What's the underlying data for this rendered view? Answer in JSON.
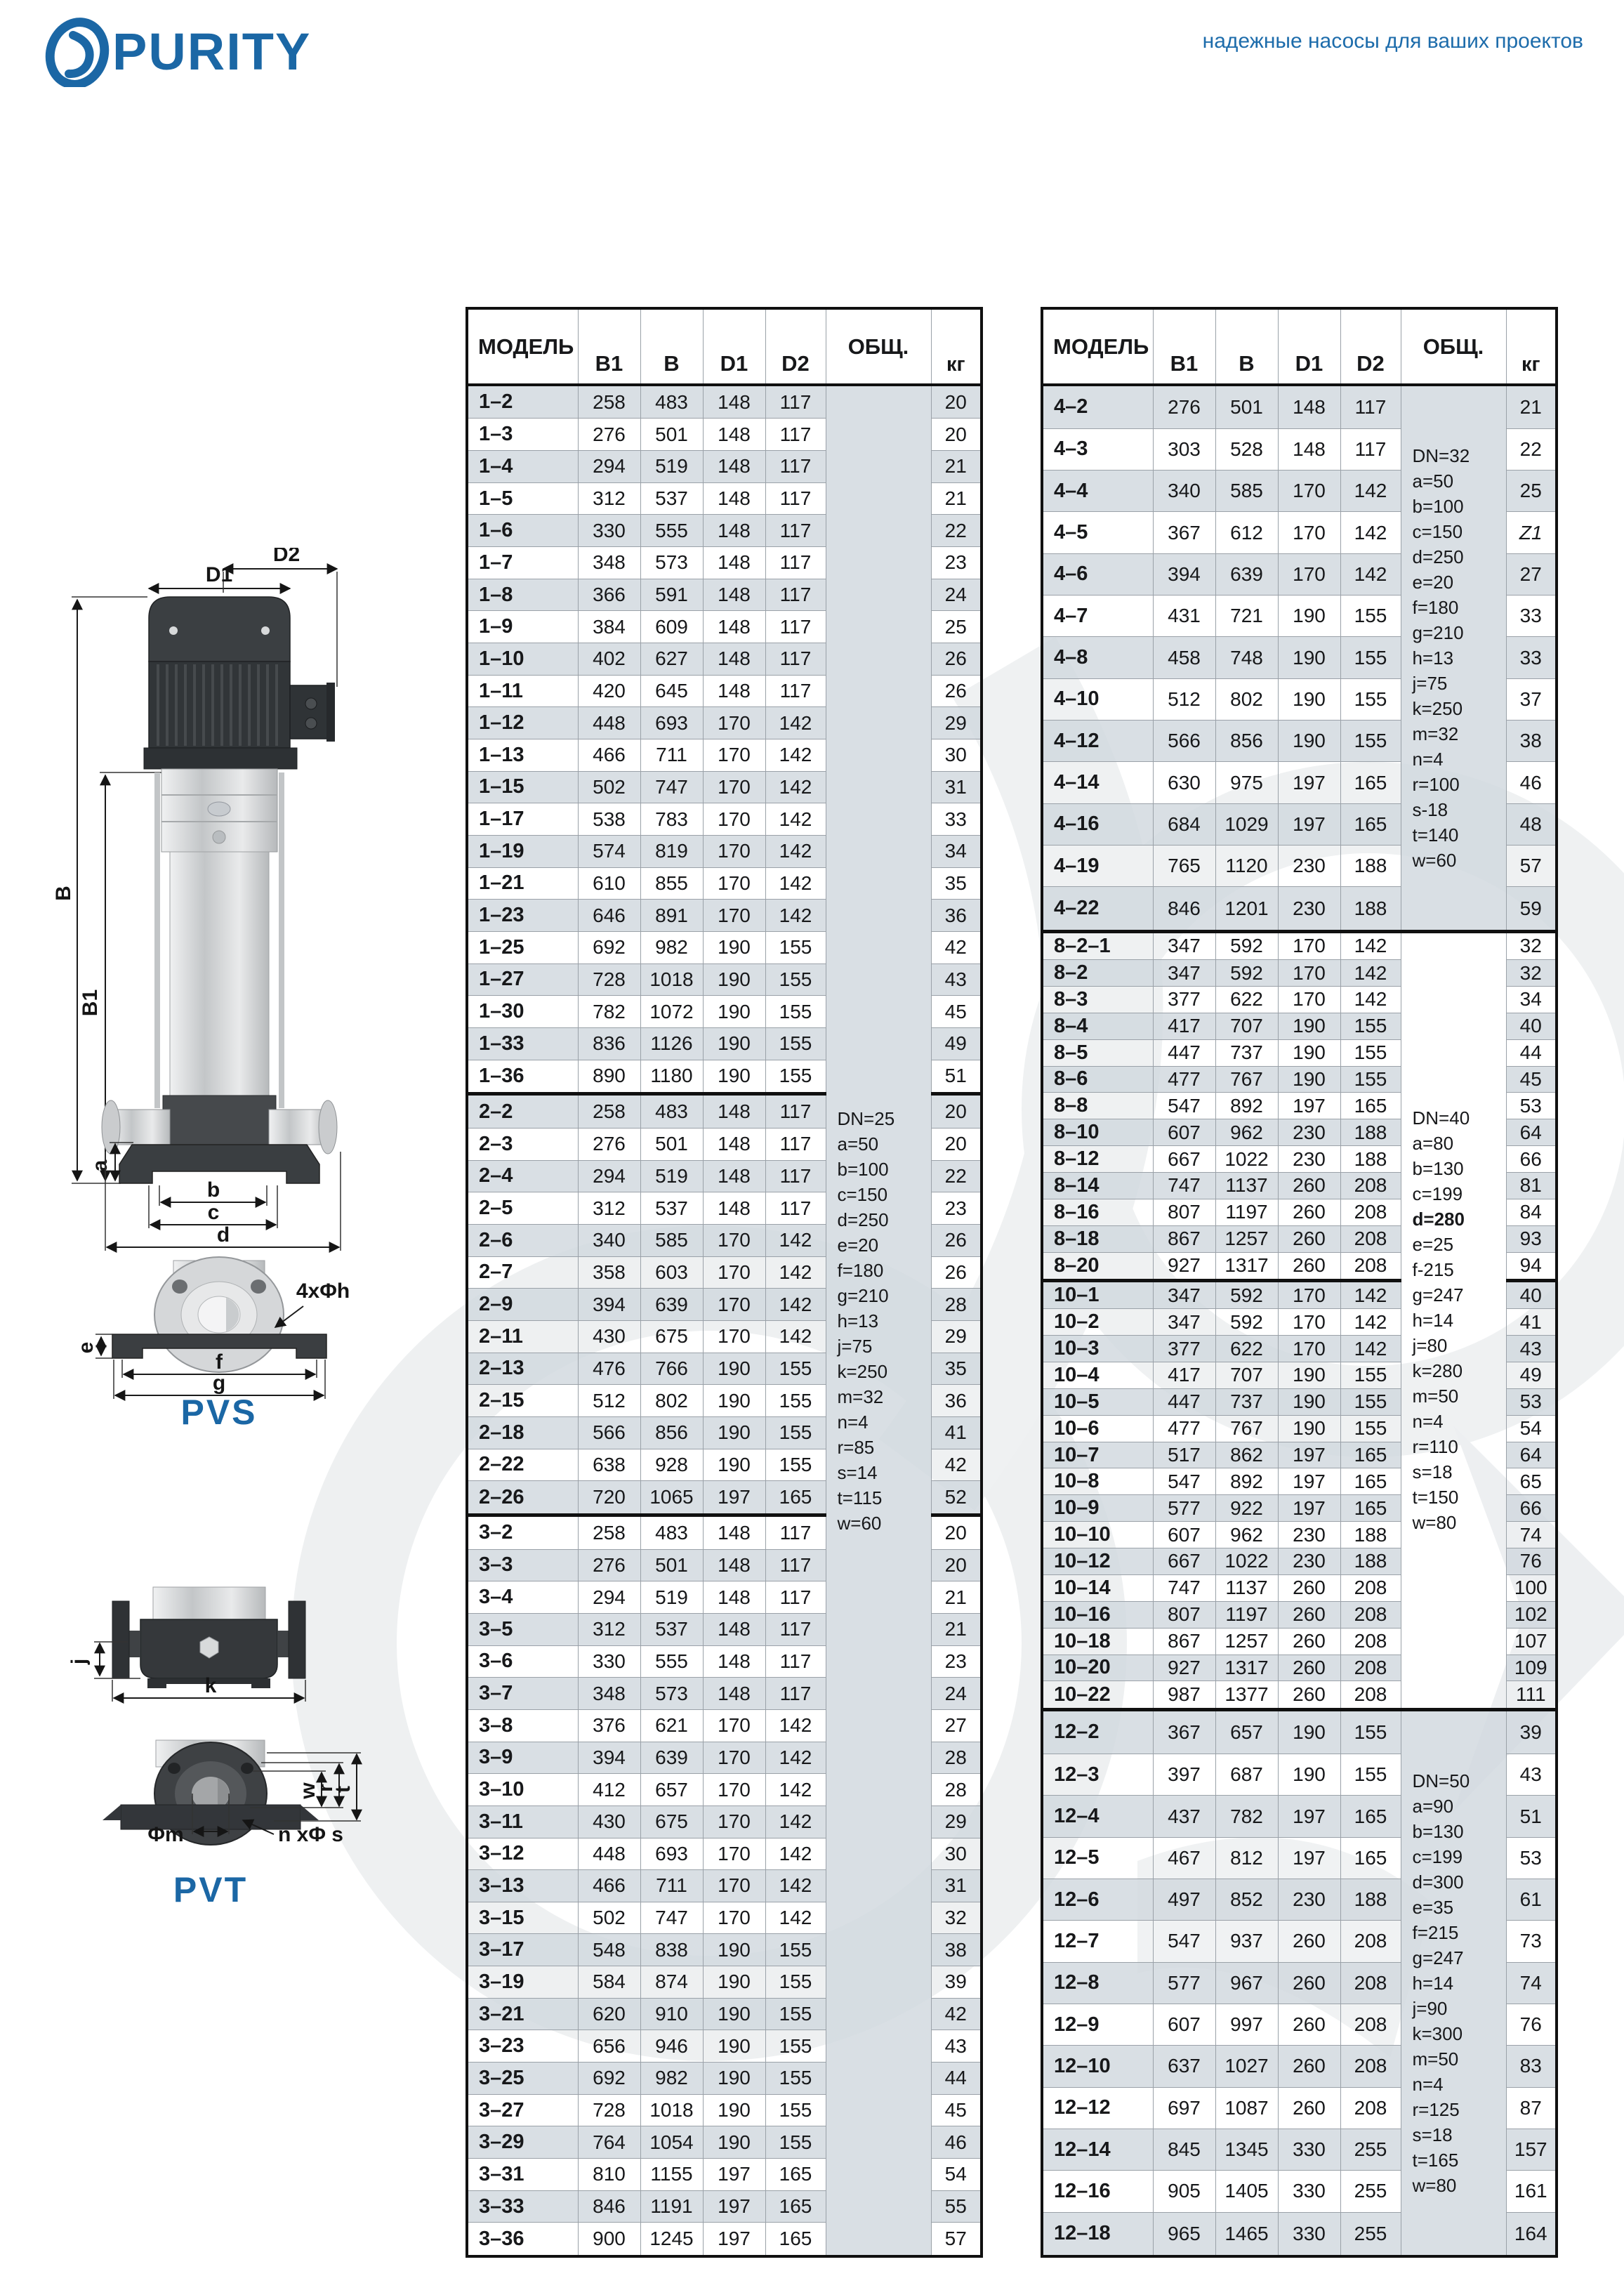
{
  "brand": {
    "logo_text": "PURITY",
    "tagline": "надежные насосы для ваших проектов"
  },
  "diagrams": {
    "pvs": {
      "label": "PVS",
      "d1": "D1",
      "d2": "D2",
      "b_total": "B",
      "b1": "B1",
      "a": "a",
      "dim_b": "b",
      "dim_c": "c",
      "dim_d": "d",
      "bolt_note": "4xΦh",
      "e": "e",
      "f": "f",
      "g": "g"
    },
    "pvt": {
      "label": "PVT",
      "j": "j",
      "k": "k",
      "m": "Φm",
      "bolt_note": "n xΦ s",
      "w": "w",
      "r": "r",
      "t": "t"
    }
  },
  "tables": {
    "headers": {
      "model": "МОДЕЛЬ",
      "b1": "B1",
      "b": "B",
      "d1": "D1",
      "d2": "D2",
      "total": "ОБЩ.",
      "kg": "кг"
    },
    "italic_kg": "Z1",
    "left": {
      "sections": [
        {
          "note_rows": 58,
          "note_lines": [
            "DN=25",
            "a=50",
            "b=100",
            "c=150",
            "d=250",
            "e=20",
            "f=180",
            "g=210",
            "h=13",
            "j=75",
            "k=250",
            "m=32",
            "n=4",
            "r=85",
            "s=14",
            "t=115",
            "w=60"
          ],
          "rows": [
            [
              "1–2",
              258,
              483,
              148,
              117,
              "20"
            ],
            [
              "1–3",
              276,
              501,
              148,
              117,
              "20"
            ],
            [
              "1–4",
              294,
              519,
              148,
              117,
              "21"
            ],
            [
              "1–5",
              312,
              537,
              148,
              117,
              "21"
            ],
            [
              "1–6",
              330,
              555,
              148,
              117,
              "22"
            ],
            [
              "1–7",
              348,
              573,
              148,
              117,
              "23"
            ],
            [
              "1–8",
              366,
              591,
              148,
              117,
              "24"
            ],
            [
              "1–9",
              384,
              609,
              148,
              117,
              "25"
            ],
            [
              "1–10",
              402,
              627,
              148,
              117,
              "26"
            ],
            [
              "1–11",
              420,
              645,
              148,
              117,
              "26"
            ],
            [
              "1–12",
              448,
              693,
              170,
              142,
              "29"
            ],
            [
              "1–13",
              466,
              711,
              170,
              142,
              "30"
            ],
            [
              "1–15",
              502,
              747,
              170,
              142,
              "31"
            ],
            [
              "1–17",
              538,
              783,
              170,
              142,
              "33"
            ],
            [
              "1–19",
              574,
              819,
              170,
              142,
              "34"
            ],
            [
              "1–21",
              610,
              855,
              170,
              142,
              "35"
            ],
            [
              "1–23",
              646,
              891,
              170,
              142,
              "36"
            ],
            [
              "1–25",
              692,
              982,
              190,
              155,
              "42"
            ],
            [
              "1–27",
              728,
              1018,
              190,
              155,
              "43"
            ],
            [
              "1–30",
              782,
              1072,
              190,
              155,
              "45"
            ],
            [
              "1–33",
              836,
              1126,
              190,
              155,
              "49"
            ],
            [
              "1–36",
              890,
              1180,
              190,
              155,
              "51"
            ]
          ]
        },
        {
          "rows": [
            [
              "2–2",
              258,
              483,
              148,
              117,
              "20"
            ],
            [
              "2–3",
              276,
              501,
              148,
              117,
              "20"
            ],
            [
              "2–4",
              294,
              519,
              148,
              117,
              "22"
            ],
            [
              "2–5",
              312,
              537,
              148,
              117,
              "23"
            ],
            [
              "2–6",
              340,
              585,
              170,
              142,
              "26"
            ],
            [
              "2–7",
              358,
              603,
              170,
              142,
              "26"
            ],
            [
              "2–9",
              394,
              639,
              170,
              142,
              "28"
            ],
            [
              "2–11",
              430,
              675,
              170,
              142,
              "29"
            ],
            [
              "2–13",
              476,
              766,
              190,
              155,
              "35"
            ],
            [
              "2–15",
              512,
              802,
              190,
              155,
              "36"
            ],
            [
              "2–18",
              566,
              856,
              190,
              155,
              "41"
            ],
            [
              "2–22",
              638,
              928,
              190,
              155,
              "42"
            ],
            [
              "2–26",
              720,
              1065,
              197,
              165,
              "52"
            ]
          ]
        },
        {
          "rows": [
            [
              "3–2",
              258,
              483,
              148,
              117,
              "20"
            ],
            [
              "3–3",
              276,
              501,
              148,
              117,
              "20"
            ],
            [
              "3–4",
              294,
              519,
              148,
              117,
              "21"
            ],
            [
              "3–5",
              312,
              537,
              148,
              117,
              "21"
            ],
            [
              "3–6",
              330,
              555,
              148,
              117,
              "23"
            ],
            [
              "3–7",
              348,
              573,
              148,
              117,
              "24"
            ],
            [
              "3–8",
              376,
              621,
              170,
              142,
              "27"
            ],
            [
              "3–9",
              394,
              639,
              170,
              142,
              "28"
            ],
            [
              "3–10",
              412,
              657,
              170,
              142,
              "28"
            ],
            [
              "3–11",
              430,
              675,
              170,
              142,
              "29"
            ],
            [
              "3–12",
              448,
              693,
              170,
              142,
              "30"
            ],
            [
              "3–13",
              466,
              711,
              170,
              142,
              "31"
            ],
            [
              "3–15",
              502,
              747,
              170,
              142,
              "32"
            ],
            [
              "3–17",
              548,
              838,
              190,
              155,
              "38"
            ],
            [
              "3–19",
              584,
              874,
              190,
              155,
              "39"
            ],
            [
              "3–21",
              620,
              910,
              190,
              155,
              "42"
            ],
            [
              "3–23",
              656,
              946,
              190,
              155,
              "43"
            ],
            [
              "3–25",
              692,
              982,
              190,
              155,
              "44"
            ],
            [
              "3–27",
              728,
              1018,
              190,
              155,
              "45"
            ],
            [
              "3–29",
              764,
              1054,
              190,
              155,
              "46"
            ],
            [
              "3–31",
              810,
              1155,
              197,
              165,
              "54"
            ],
            [
              "3–33",
              846,
              1191,
              197,
              165,
              "55"
            ],
            [
              "3–36",
              900,
              1245,
              197,
              165,
              "57"
            ]
          ]
        }
      ]
    },
    "right": {
      "sections": [
        {
          "note_rows": 13,
          "note_lines": [
            "DN=32",
            "a=50",
            "b=100",
            "c=150",
            "d=250",
            "e=20",
            "f=180",
            "g=210",
            "h=13",
            "j=75",
            "k=250",
            "m=32",
            "n=4",
            "r=100",
            "s-18",
            "t=140",
            "w=60"
          ],
          "rows": [
            [
              "4–2",
              276,
              501,
              148,
              117,
              "21"
            ],
            [
              "4–3",
              303,
              528,
              148,
              117,
              "22"
            ],
            [
              "4–4",
              340,
              585,
              170,
              142,
              "25"
            ],
            [
              "4–5",
              367,
              612,
              170,
              142,
              "Z1"
            ],
            [
              "4–6",
              394,
              639,
              170,
              142,
              "27"
            ],
            [
              "4–7",
              431,
              721,
              190,
              155,
              "33"
            ],
            [
              "4–8",
              458,
              748,
              190,
              155,
              "33"
            ],
            [
              "4–10",
              512,
              802,
              190,
              155,
              "37"
            ],
            [
              "4–12",
              566,
              856,
              190,
              155,
              "38"
            ],
            [
              "4–14",
              630,
              975,
              197,
              165,
              "46"
            ],
            [
              "4–16",
              684,
              1029,
              197,
              165,
              "48"
            ],
            [
              "4–19",
              765,
              1120,
              230,
              188,
              "57"
            ],
            [
              "4–22",
              846,
              1201,
              230,
              188,
              "59"
            ]
          ]
        },
        {
          "note_rows": 29,
          "note_bold_line": 4,
          "note_lines": [
            "DN=40",
            "a=80",
            "b=130",
            "c=199",
            "d=280",
            "e=25",
            "f-215",
            "g=247",
            "h=14",
            "j=80",
            "k=280",
            "m=50",
            "n=4",
            "r=110",
            "s=18",
            "t=150",
            "w=80"
          ],
          "rows": [
            [
              "8–2–1",
              347,
              592,
              170,
              142,
              "32"
            ],
            [
              "8–2",
              347,
              592,
              170,
              142,
              "32"
            ],
            [
              "8–3",
              377,
              622,
              170,
              142,
              "34"
            ],
            [
              "8–4",
              417,
              707,
              190,
              155,
              "40"
            ],
            [
              "8–5",
              447,
              737,
              190,
              155,
              "44"
            ],
            [
              "8–6",
              477,
              767,
              190,
              155,
              "45"
            ],
            [
              "8–8",
              547,
              892,
              197,
              165,
              "53"
            ],
            [
              "8–10",
              607,
              962,
              230,
              188,
              "64"
            ],
            [
              "8–12",
              667,
              1022,
              230,
              188,
              "66"
            ],
            [
              "8–14",
              747,
              1137,
              260,
              208,
              "81"
            ],
            [
              "8–16",
              807,
              1197,
              260,
              208,
              "84"
            ],
            [
              "8–18",
              867,
              1257,
              260,
              208,
              "93"
            ],
            [
              "8–20",
              927,
              1317,
              260,
              208,
              "94"
            ]
          ]
        },
        {
          "rows": [
            [
              "10–1",
              347,
              592,
              170,
              142,
              "40"
            ],
            [
              "10–2",
              347,
              592,
              170,
              142,
              "41"
            ],
            [
              "10–3",
              377,
              622,
              170,
              142,
              "43"
            ],
            [
              "10–4",
              417,
              707,
              190,
              155,
              "49"
            ],
            [
              "10–5",
              447,
              737,
              190,
              155,
              "53"
            ],
            [
              "10–6",
              477,
              767,
              190,
              155,
              "54"
            ],
            [
              "10–7",
              517,
              862,
              197,
              165,
              "64"
            ],
            [
              "10–8",
              547,
              892,
              197,
              165,
              "65"
            ],
            [
              "10–9",
              577,
              922,
              197,
              165,
              "66"
            ],
            [
              "10–10",
              607,
              962,
              230,
              188,
              "74"
            ],
            [
              "10–12",
              667,
              1022,
              230,
              188,
              "76"
            ],
            [
              "10–14",
              747,
              1137,
              260,
              208,
              "100"
            ],
            [
              "10–16",
              807,
              1197,
              260,
              208,
              "102"
            ],
            [
              "10–18",
              867,
              1257,
              260,
              208,
              "107"
            ],
            [
              "10–20",
              927,
              1317,
              260,
              208,
              "109"
            ],
            [
              "10–22",
              987,
              1377,
              260,
              208,
              "111"
            ]
          ]
        },
        {
          "note_rows": 13,
          "note_lines": [
            "DN=50",
            "a=90",
            "b=130",
            "c=199",
            "d=300",
            "e=35",
            "f=215",
            "g=247",
            "h=14",
            "j=90",
            "k=300",
            "m=50",
            "n=4",
            "r=125",
            "s=18",
            "t=165",
            "w=80"
          ],
          "rows": [
            [
              "12–2",
              367,
              657,
              190,
              155,
              "39"
            ],
            [
              "12–3",
              397,
              687,
              190,
              155,
              "43"
            ],
            [
              "12–4",
              437,
              782,
              197,
              165,
              "51"
            ],
            [
              "12–5",
              467,
              812,
              197,
              165,
              "53"
            ],
            [
              "12–6",
              497,
              852,
              230,
              188,
              "61"
            ],
            [
              "12–7",
              547,
              937,
              260,
              208,
              "73"
            ],
            [
              "12–8",
              577,
              967,
              260,
              208,
              "74"
            ],
            [
              "12–9",
              607,
              997,
              260,
              208,
              "76"
            ],
            [
              "12–10",
              637,
              1027,
              260,
              208,
              "83"
            ],
            [
              "12–12",
              697,
              1087,
              260,
              208,
              "87"
            ],
            [
              "12–14",
              845,
              1345,
              330,
              255,
              "157"
            ],
            [
              "12–16",
              905,
              1405,
              330,
              255,
              "161"
            ],
            [
              "12–18",
              965,
              1465,
              330,
              255,
              "164"
            ]
          ]
        }
      ]
    }
  }
}
